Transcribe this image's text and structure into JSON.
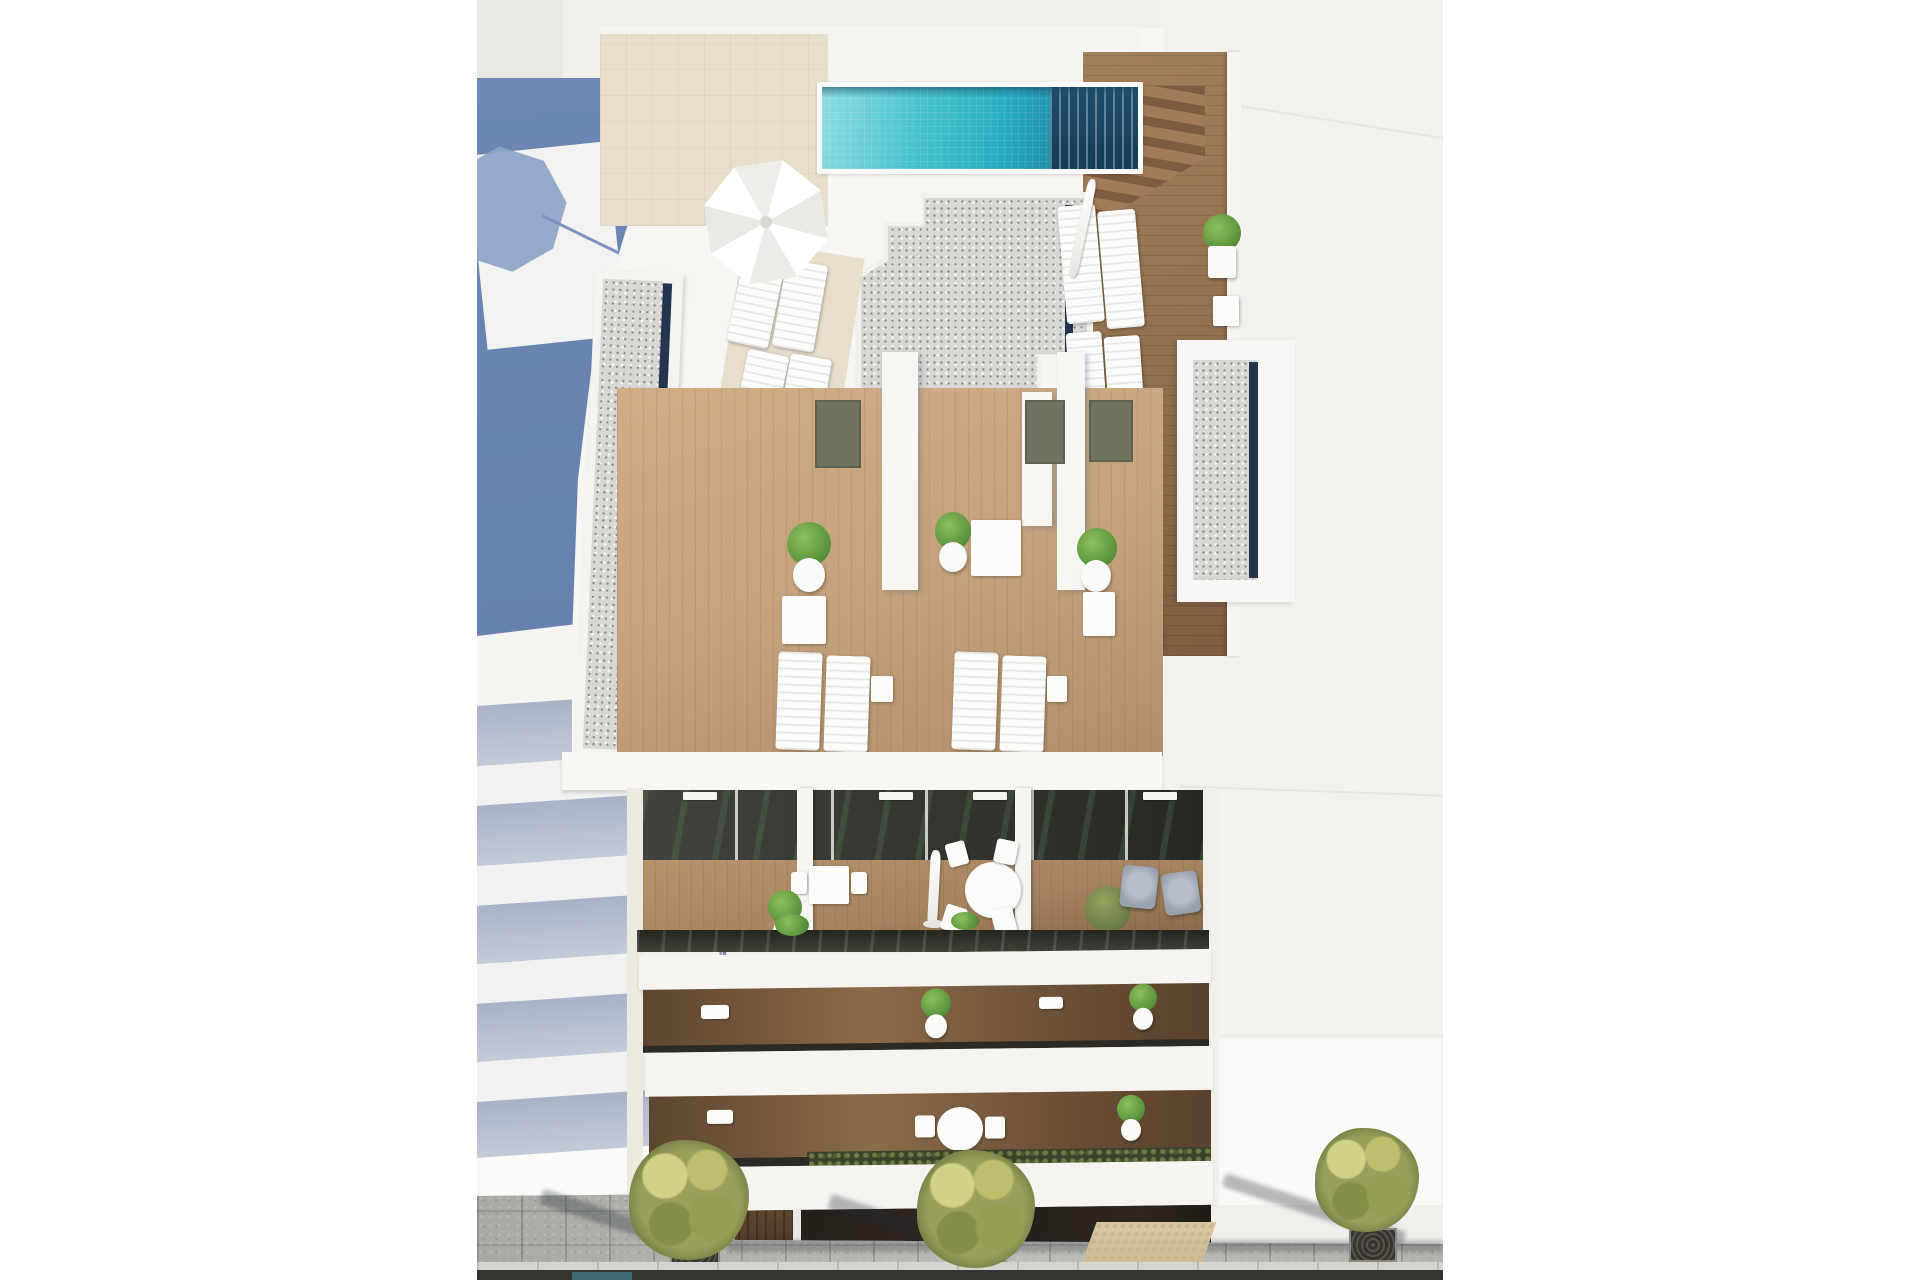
{
  "meta": {
    "type": "architectural-render",
    "description": "Photorealistic aerial 3D architectural rendering of a modern white apartment building, viewed from above: a turquoise tiled rooftop swimming pool with wooden sun deck and stairs, a white parasol with sun loungers, gravel flat roofs with navy skylight strips, private wood-decked roof terraces with potted plants, small tables and lounger pairs, a recessed balcony level with a round dining set, closed parasol and grey armchairs, two lower balcony strips with plants, a dark ground-floor storefront, and a grey-paved sidewalk with three olive street trees, tree grates and a beige tactile paving patch. A large slate-blue building shadow and a stepped white neighbouring building occupy the left side; a plain light rooftop occupies the right."
  },
  "labels": {
    "scene": "Aerial render of white apartment building",
    "render_canvas": "Rendered image area",
    "neighbor_left": "Adjacent building with stepped balconies (left)",
    "building_shadow": "Slate-blue cast shadow",
    "umbrella_shadow": "Parasol shadow on neighbouring roof",
    "neighbor_right": "Adjacent light rooftop (right)",
    "rooftop": "Rooftop solarium with pool",
    "pool": "Turquoise rooftop swimming pool",
    "pool_deck": "Wooden pool deck with stairs",
    "beige_paving": "Sand-coloured rooftop paving",
    "parasol": "White parasol",
    "sun_loungers": "White sun loungers",
    "gravel_roof": "Gravel roof with navy skylight strip",
    "terraces": "Private roof terraces with wooden decking",
    "terrace_door": "Terrace access door",
    "plant": "Potted green shrub",
    "bistro_table": "Small white bistro table",
    "balcony_level": "Recessed balcony with glass doors",
    "dining_set": "Round white dining table with chairs",
    "armchairs": "Grey lounge armchairs",
    "glass_balustrade": "Glass balcony balustrade",
    "lower_balconies": "Lower balcony strips with planters",
    "hedge": "Balcony hedge planter",
    "storefront": "Dark ground-floor storefront",
    "sidewalk": "Grey paved sidewalk",
    "tactile_paving": "Beige tactile paving patch",
    "street_tree": "Olive street tree in grate",
    "road": "Road edge strip"
  },
  "colors": {
    "page": "#ffffff",
    "canvas": "#f0efec",
    "blue": "#6d86b4",
    "white_bld": "#f7f6f3",
    "fascia": "#f5f4f1",
    "beige": "#e7decb",
    "pool_a": "#8edde0",
    "pool_b": "#49c3cf",
    "pool_c": "#2aaec1",
    "pool_d": "#176c8c",
    "navy": "#22344e",
    "gravel": "#d8d7d3",
    "deck": "#8f6e4e",
    "terrace": "#c3a27c",
    "balcony_wood": "#a5835f",
    "glass": "#30332b",
    "shade": "#a9b3c7",
    "paving": "#b6b7b1",
    "tactile": "#d8c7a2",
    "olive": "#9aa05c",
    "olive_d": "#6e7740",
    "road": "#35332f",
    "door": "#6f7360",
    "chair": "#98a1ae"
  }
}
